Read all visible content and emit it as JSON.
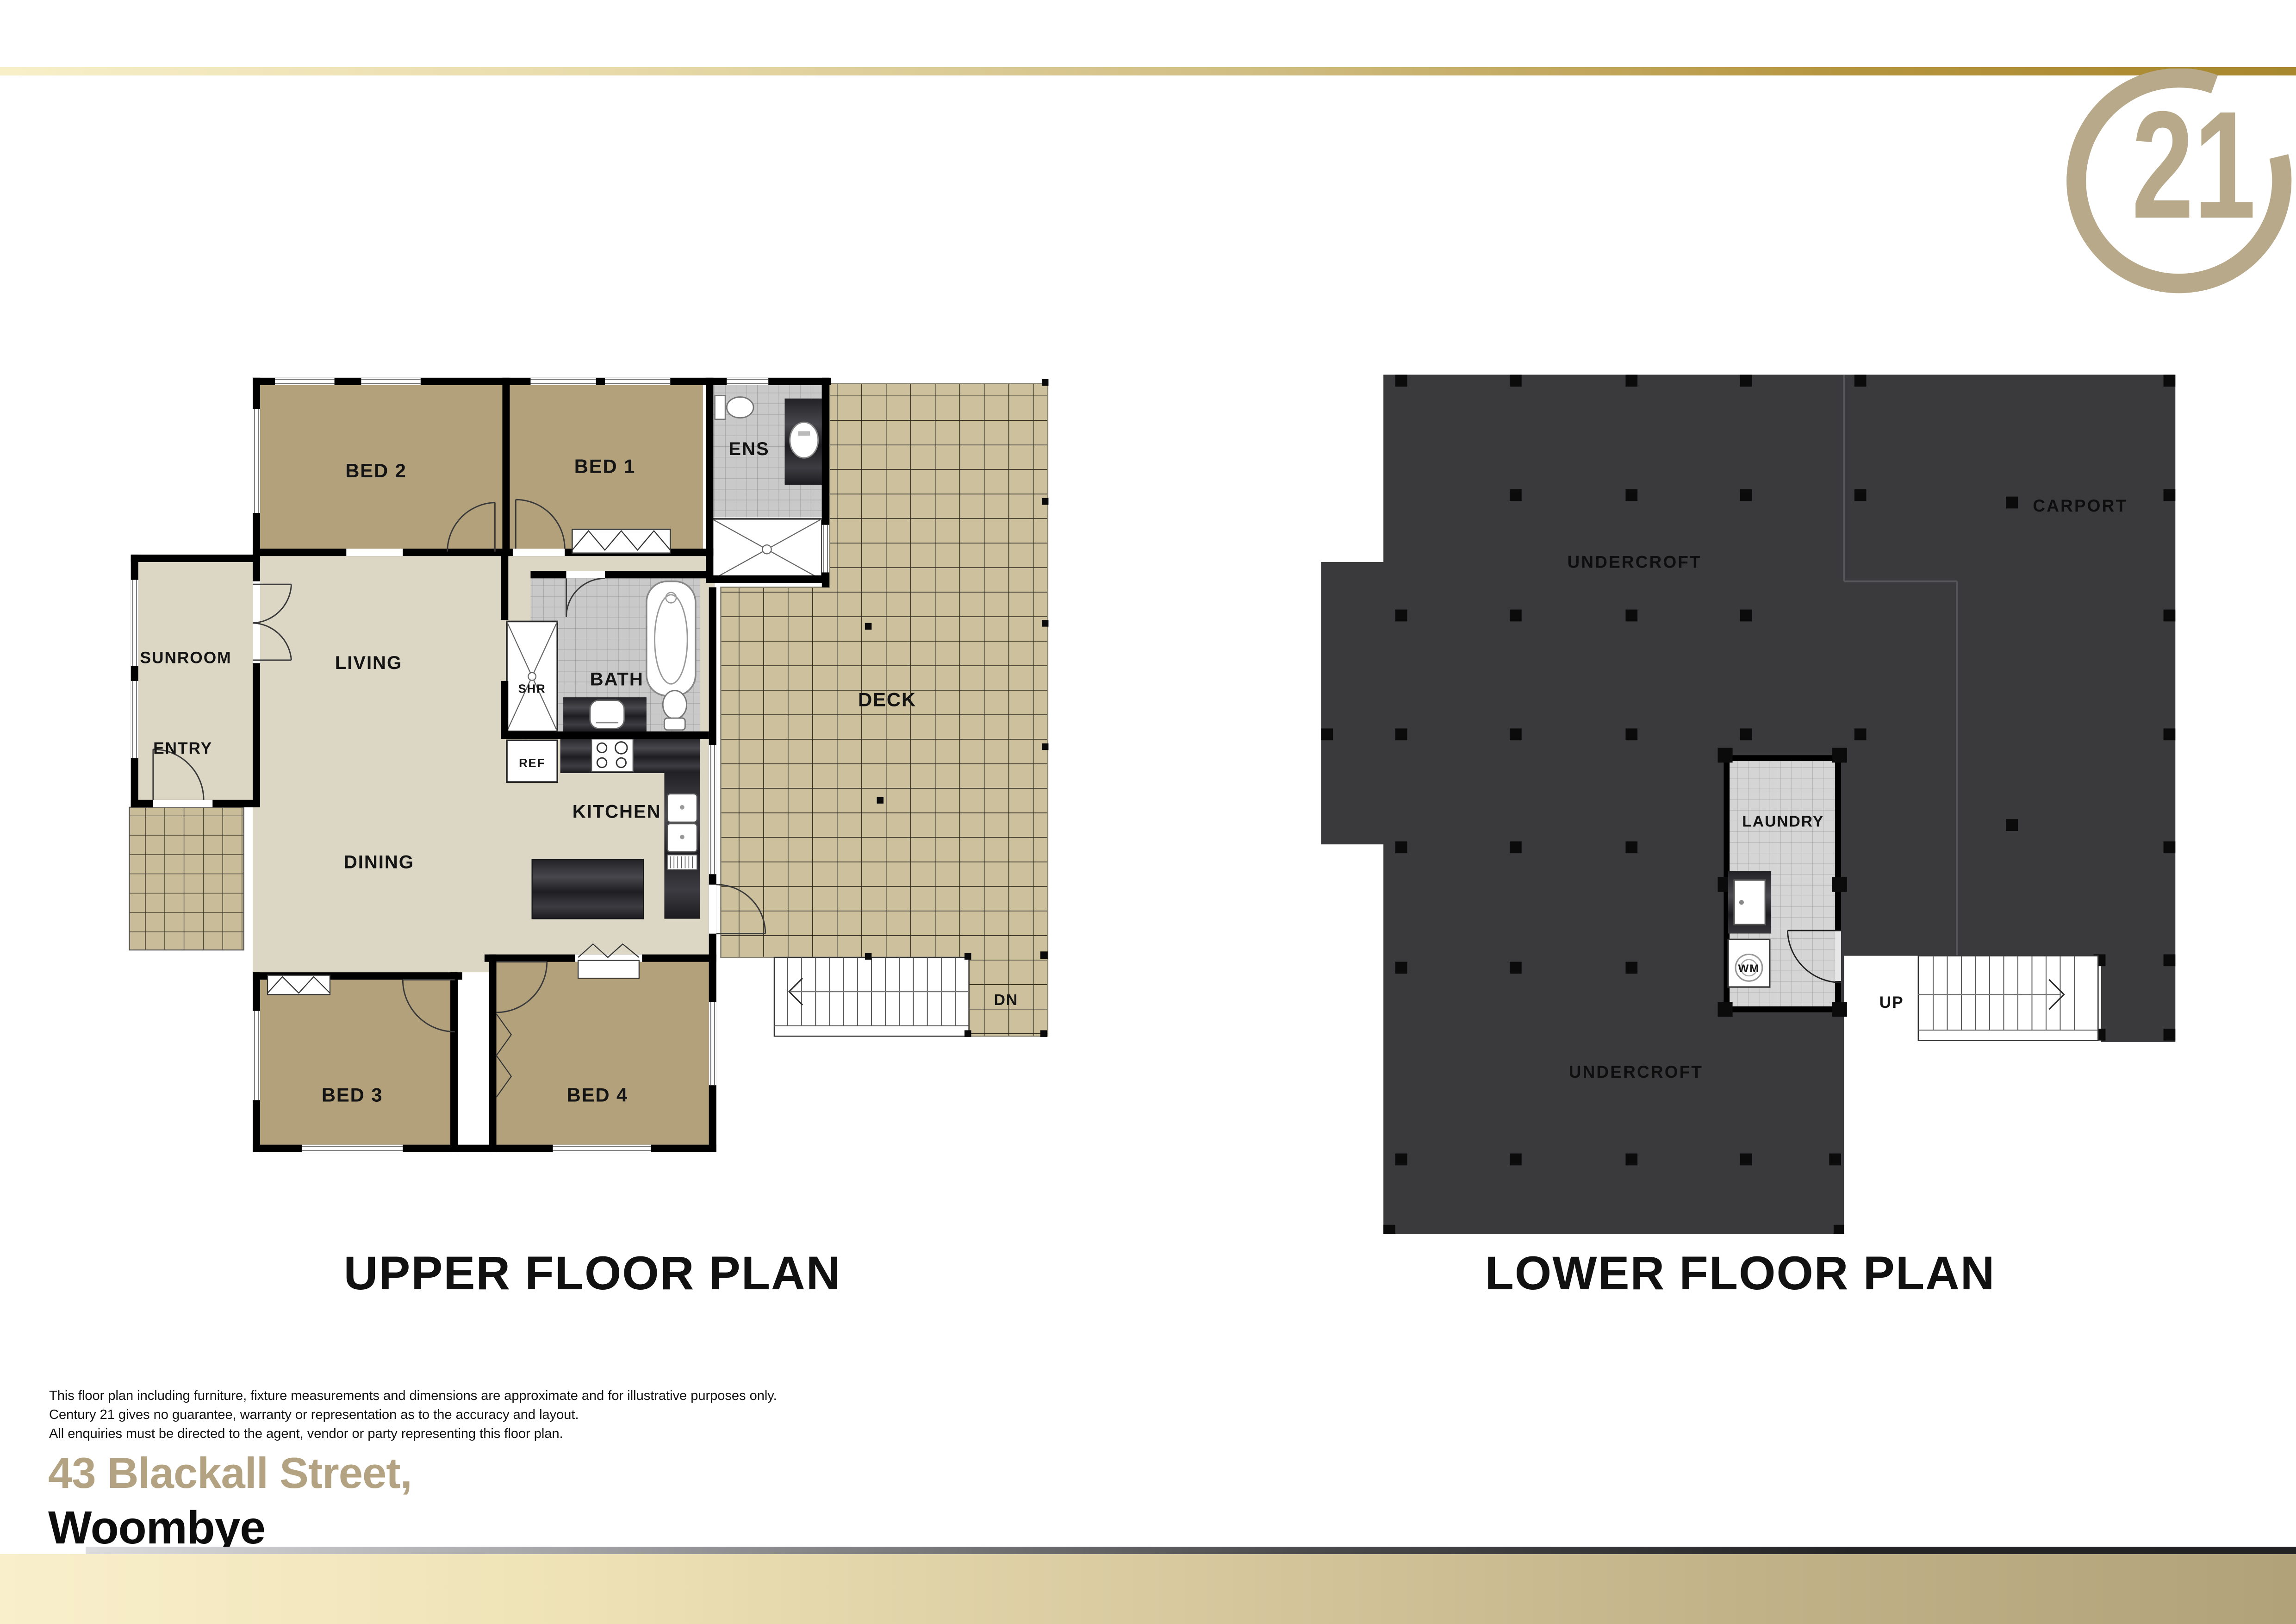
{
  "header": {
    "logo_numeral": "21"
  },
  "upper_plan": {
    "title": "UPPER FLOOR PLAN",
    "rooms": {
      "bed2": "BED 2",
      "bed1": "BED 1",
      "ens": "ENS",
      "sunroom": "SUNROOM",
      "living": "LIVING",
      "entry": "ENTRY",
      "bath": "BATH",
      "shr": "SHR",
      "ref": "REF",
      "kitchen": "KITCHEN",
      "dining": "DINING",
      "deck": "DECK",
      "dn": "DN",
      "bed3": "BED 3",
      "bed4": "BED 4"
    }
  },
  "lower_plan": {
    "title": "LOWER FLOOR PLAN",
    "rooms": {
      "undercroft_top": "UNDERCROFT",
      "carport": "CARPORT",
      "laundry": "LAUNDRY",
      "wm": "WM",
      "up": "UP",
      "undercroft_bottom": "UNDERCROFT"
    }
  },
  "footer": {
    "disclaimer_lines": [
      "This floor plan including furniture, fixture measurements and dimensions are approximate and for illustrative purposes only.",
      "Century 21 gives no guarantee, warranty or representation as to the accuracy and layout.",
      "All enquiries must be directed to the agent, vendor or party representing this floor plan."
    ],
    "address_line1": "43 Blackall Street,",
    "address_line2": "Woombye"
  },
  "colors": {
    "gold": "#b3a382",
    "logo_gold": "#b7a98a",
    "bedroom_tan": "#b2a17b",
    "floor_beige": "#dcd6c4",
    "deck_tile": "#cdc09c",
    "gray_tile": "#c9c9c9",
    "slab_dark": "#3a3a3c",
    "wall_black": "#000000"
  }
}
